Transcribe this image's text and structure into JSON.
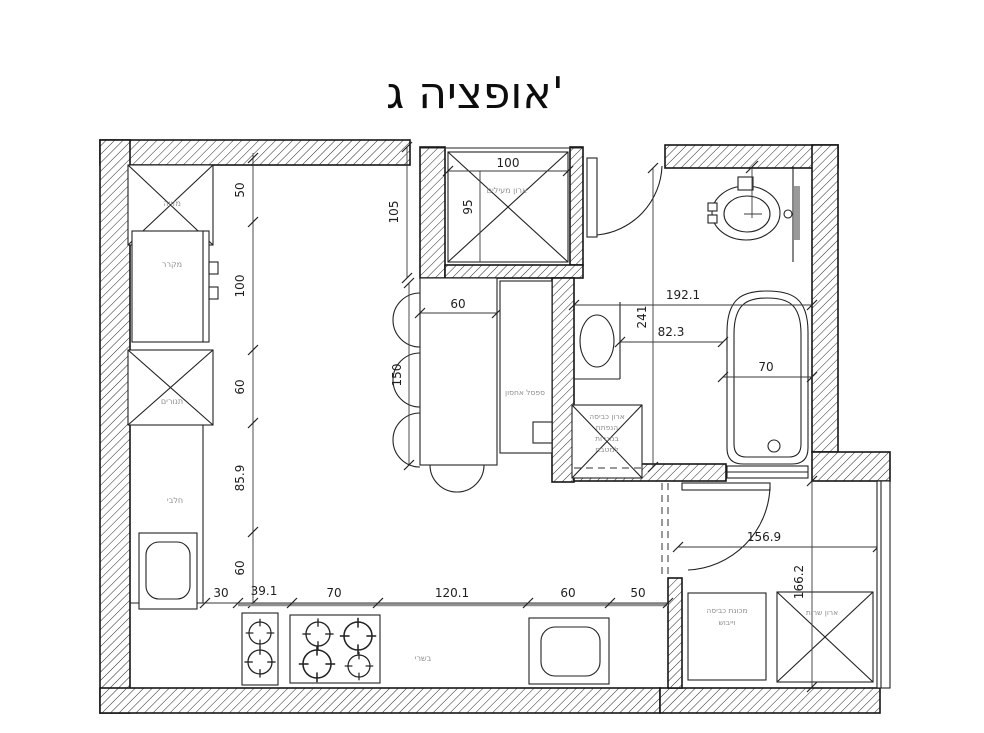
{
  "title": "אופציה ג'",
  "plan": {
    "labels": {
      "pantry": "מזווה",
      "fridge": "מקרר",
      "ovens": "תנורים",
      "dairy_counter": "חלבי",
      "meat_counter": "בשרי",
      "storage_bench": "ספסל אחסון",
      "coat_closet": "ארון מעילים",
      "bath_cabinet": [
        "ארון כביסה",
        "הנפתח",
        "במגרות",
        "למטבח"
      ],
      "washer_dryer": [
        "מכונת כביסה",
        "וייבוש"
      ],
      "service_closet": "ארון שרות"
    },
    "dims": {
      "left_wall": [
        "50",
        "100",
        "60",
        "85.9",
        "60"
      ],
      "bottom_wall": [
        "30",
        "39.1",
        "70",
        "120.1",
        "60",
        "50"
      ],
      "coat_closet": {
        "outer": "105",
        "width": "100",
        "depth": "95"
      },
      "island": {
        "width": "60",
        "length": "150"
      },
      "bathroom": {
        "width": "192.1",
        "length": "241",
        "inner": "82.3",
        "tub": "70"
      },
      "laundry": {
        "width": "156.9",
        "length": "166.2"
      }
    }
  },
  "colors": {
    "line": "#1a1a1a",
    "label_text": "#8f8f8f",
    "dim_text": "#1f1f1f",
    "counter_edge": "#999999",
    "background": "#ffffff"
  }
}
